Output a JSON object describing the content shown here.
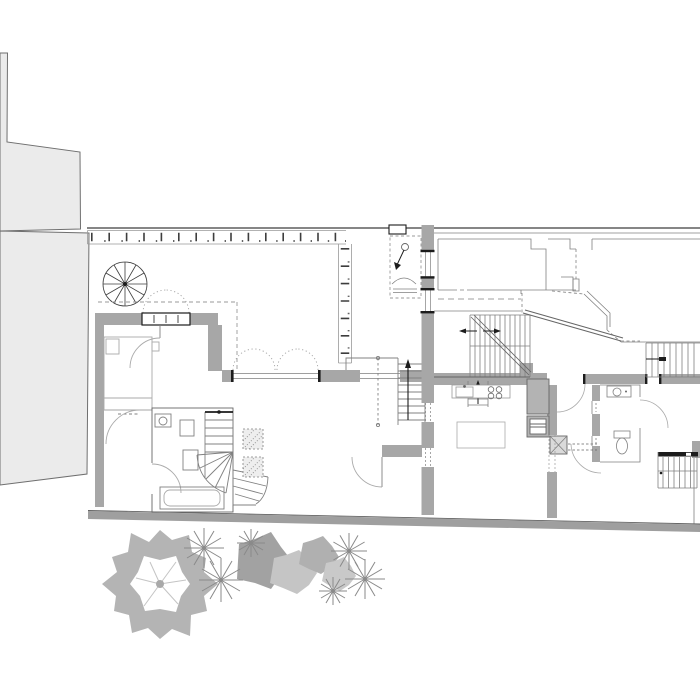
{
  "canvas": {
    "width": 700,
    "height": 700,
    "background": "#ffffff"
  },
  "drawing": {
    "kind": "architectural-floor-plan",
    "aria_label": "architectural ground floor plan with roof terrace, two flats and garden planting"
  },
  "palette": {
    "bg": "#ffffff",
    "neighbor_fill": "#ebebeb",
    "neighbor_stroke": "#6f6f6f",
    "wall_fill": "#a7a7a7",
    "wall_fill_light": "#b3b3b3",
    "black": "#1c1c1c",
    "dark_line": "#3d3d3d",
    "mid_line": "#666666",
    "thin_line": "#808080",
    "light_line": "#aaaaaa",
    "fixture_line": "#999999",
    "dashed_line": "#9a9a9a",
    "band_fill": "#9f9f9f",
    "band_edge": "#616161",
    "grille_fill": "#dadada",
    "planter_fill": "#eeeeee",
    "tree_ring": "#b4b4b4",
    "tree_vein": "#c4c4c4",
    "tree_core": "#a9a9a9",
    "shrub_dark": "#a2a2a2",
    "shrub_mid": "#b0b0b0",
    "shrub_light": "#c5c5c5",
    "shrub_pale": "#c9c9c9",
    "palm_stroke": "#8a8a8a",
    "white": "#ffffff"
  },
  "elements": {
    "legend": [
      "neighboring-building-mass",
      "roof-terrace",
      "planter-railing-border",
      "spiral-stair",
      "roof-hatch-symbol",
      "bedroom",
      "bed",
      "bathroom",
      "bathtub",
      "washbasin",
      "winder-stair",
      "living-room",
      "folding-terrace-door",
      "internal-stair",
      "kitchen",
      "kitchen-counter",
      "sink",
      "hob",
      "kitchen-island",
      "tall-units",
      "floor-grille",
      "main-staircase",
      "upper-floor-outline",
      "hallway",
      "small-bathroom",
      "toilet",
      "entrance-staircase",
      "garden-boundary-wall",
      "garden-tree",
      "shrubs",
      "palm-plants"
    ]
  }
}
